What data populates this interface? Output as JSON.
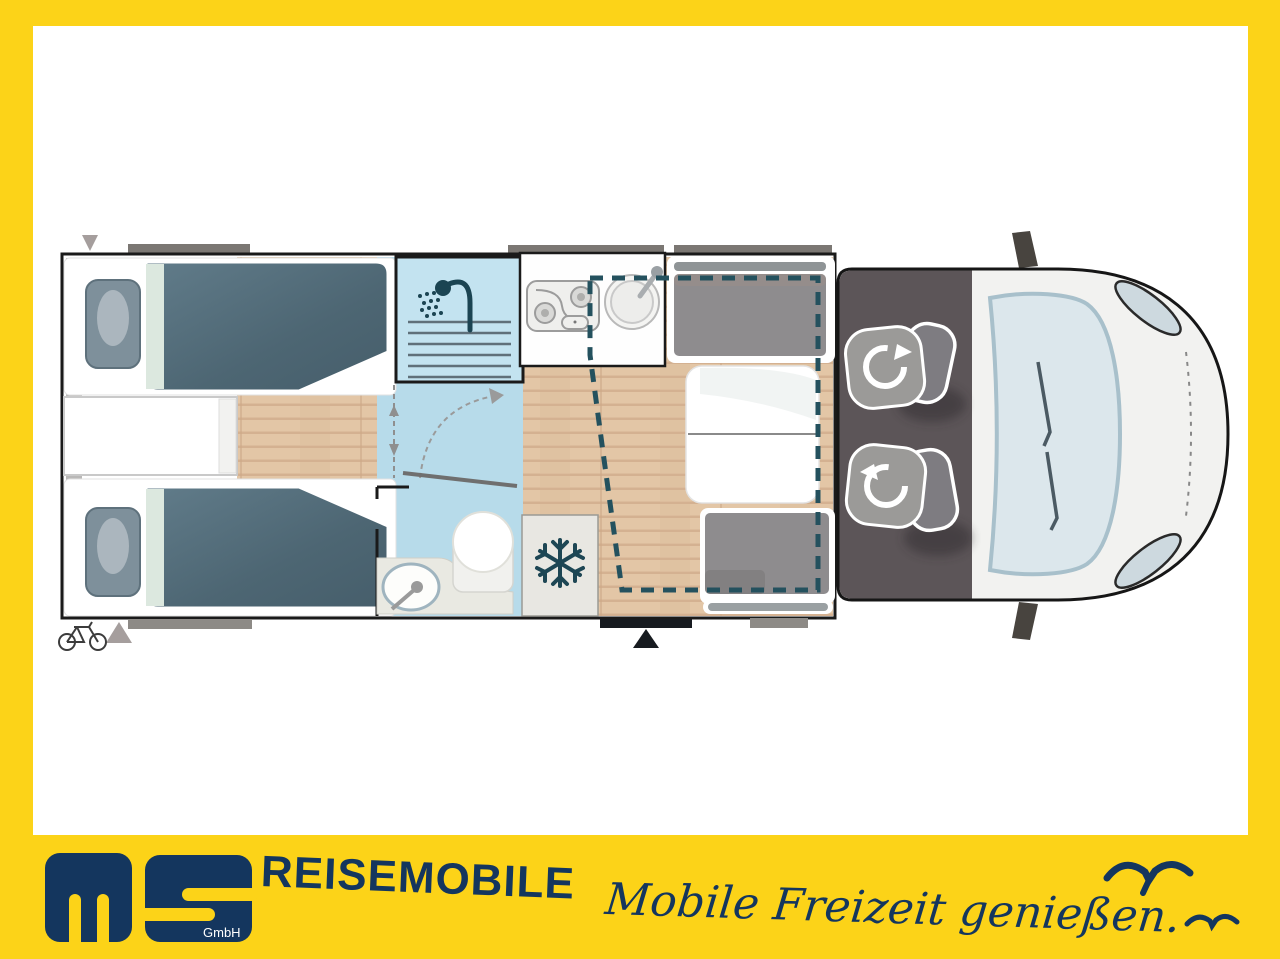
{
  "frame": {
    "border_color": "#FCD318",
    "inner_background": "#FFFFFF"
  },
  "banner": {
    "brand": "REISEMOBILE",
    "tagline": "Mobile Freizeit genießen.",
    "logo_sub": "GmbH",
    "brand_color": "#14365E",
    "icons": [
      "seagull-icon-large",
      "seagull-icon-small",
      "ms-logo"
    ]
  },
  "floorplan": {
    "view": "motorhome top-view layout drawing",
    "features": [
      "twin-single-bed-top",
      "twin-single-bed-bottom",
      "pillows",
      "bedside-cabinet",
      "shower-cabin",
      "washbasin",
      "toilet",
      "folding-bathroom-door",
      "kitchen-hob",
      "kitchen-round-sink",
      "refrigerator",
      "dinette-seat-front",
      "dinette-seat-rear",
      "dinette-table",
      "drop-down-bed-dashed-outline",
      "entry-door-marker",
      "bike-storage-icon",
      "overhead-window-rear",
      "overhead-window-kitchen",
      "overhead-window-dinette",
      "cab-swivel-seat-driver",
      "cab-swivel-seat-passenger",
      "windshield",
      "headlight-left",
      "headlight-right",
      "side-mirror-top",
      "side-mirror-bottom"
    ],
    "colors": {
      "floor_wood": "#E2C5A5",
      "bathroom_blue": "#B7DBEA",
      "shower_blue": "#C3E3F0",
      "mattress": "#53707E",
      "cushion_gray": "#8E8C8E",
      "cab_floor": "#5C5558",
      "dashed_bed_outline": "#24515E",
      "wall_outline": "#1A1A1A"
    }
  }
}
